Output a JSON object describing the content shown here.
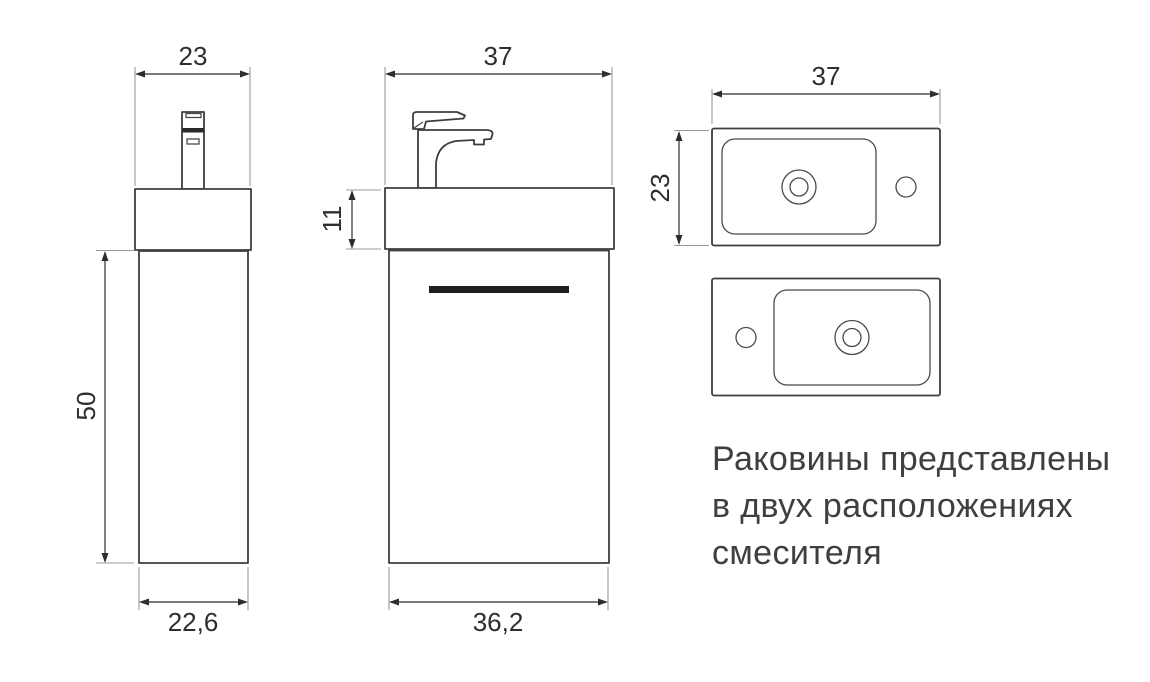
{
  "drawing": {
    "type": "technical-dimension-drawing",
    "subject": "wall-hung washbasin cabinet with faucet",
    "side_view": {
      "dim_top_width": "23",
      "dim_height": "50",
      "dim_bottom_width": "22,6"
    },
    "front_view": {
      "dim_top_width": "37",
      "dim_basin_height": "11",
      "dim_bottom_width": "36,2"
    },
    "top_view": {
      "dim_width": "37",
      "dim_depth": "23"
    },
    "note": {
      "lines": [
        "Раковины представлены",
        "в двух расположениях",
        "смесителя"
      ]
    },
    "colors": {
      "background": "#ffffff",
      "outline": "#3e3e3e",
      "dimension": "#2e2e2e",
      "extension_line": "#9b9b9b",
      "door_handle": "#1f1f1f",
      "note_text": "#3f3f3f"
    }
  }
}
